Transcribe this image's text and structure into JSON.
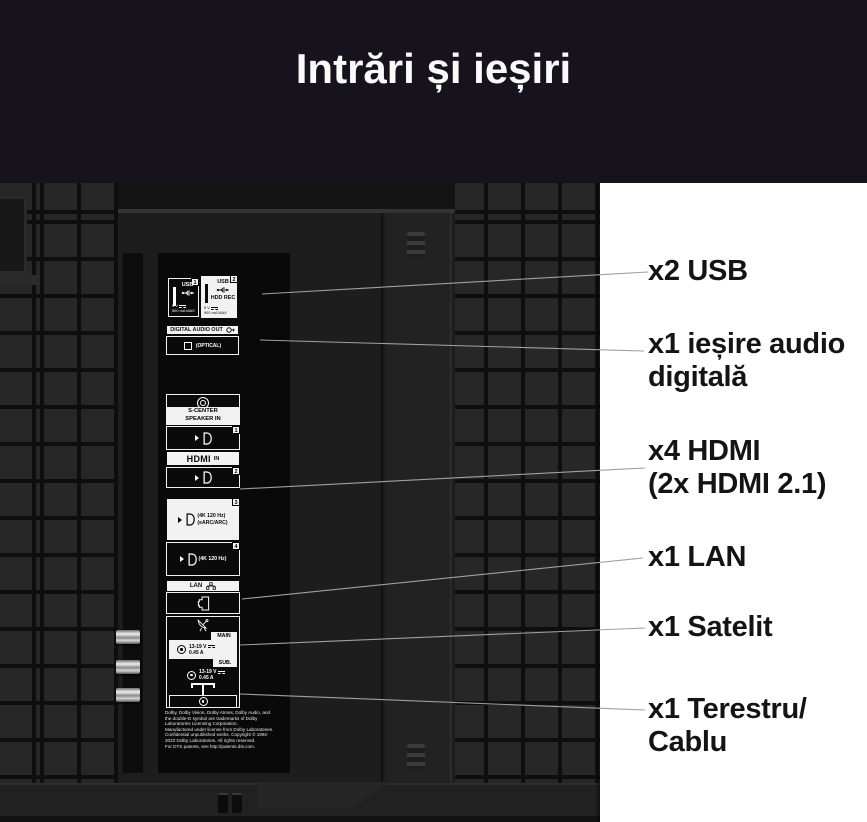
{
  "header": {
    "title": "Intrări și ieșiri"
  },
  "panel": {
    "usb1": {
      "num": "1",
      "label": "USB",
      "volt": "5 V",
      "amp": "500 mA MAX"
    },
    "usb2": {
      "num": "2",
      "label": "USB",
      "hdd": "HDD REC",
      "volt": "5 V",
      "amp": "900 mA MAX"
    },
    "dao": {
      "label": "DIGITAL AUDIO OUT",
      "optical": "(OPTICAL)"
    },
    "scenter": {
      "l1": "S-CENTER",
      "l2": "SPEAKER IN"
    },
    "hdmi": {
      "logo": "HDMI",
      "infix": "IN",
      "n1": "1",
      "n2": "2",
      "n3": "3",
      "n4": "4",
      "p3l1": "(4K 120 Hz)",
      "p3l2": "(eARC/ARC)",
      "p4l1": "(4K 120 Hz)"
    },
    "lan": {
      "label": "LAN"
    },
    "sat": {
      "main_tab": "MAIN",
      "main_l1": "13-19 V",
      "main_l2": "0.45 A",
      "sub_tab": "SUB.",
      "sub_l1": "13-19 V",
      "sub_l2": "0.45 A"
    },
    "fine_print": [
      "Dolby, Dolby Vision, Dolby Atmos, Dolby Audio, and",
      "the double-D symbol are trademarks of Dolby",
      "Laboratories Licensing Corporation.",
      "Manufactured under license from Dolby Laboratories.",
      "Confidential unpublished works. Copyright © 1992-",
      "2022 Dolby Laboratories. All rights reserved.",
      "For DTS patents, see http://patents.dts.com."
    ]
  },
  "callouts": [
    {
      "lines": [
        "x2 USB"
      ]
    },
    {
      "lines": [
        "x1 ieșire audio",
        "digitală"
      ]
    },
    {
      "lines": [
        "x4 HDMI",
        "(2x HDMI 2.1)"
      ]
    },
    {
      "lines": [
        "x1 LAN"
      ]
    },
    {
      "lines": [
        "x1 Satelit"
      ]
    },
    {
      "lines": [
        "x1 Terestru/",
        "Cablu"
      ]
    }
  ],
  "icons": {
    "usb": "usb-trident-icon",
    "audio_out": "audio-out-arrow-icon",
    "optical": "optical-square-icon",
    "minijack": "minijack-icon",
    "hdmi": "hdmi-plug-icon",
    "lan": "network-nodes-icon",
    "rj45": "ethernet-port-icon",
    "satellite": "satellite-dish-icon",
    "antenna": "t-antenna-icon",
    "coax": "coax-connector-icon",
    "dc": "dc-power-icon"
  },
  "colors": {
    "banner": "#16131d",
    "label_text": "#141414",
    "callout_line": "#a0a0a0",
    "sticker_white": "#f2f2f2",
    "sticker_black": "#0a0a0a",
    "background": "#ffffff"
  }
}
